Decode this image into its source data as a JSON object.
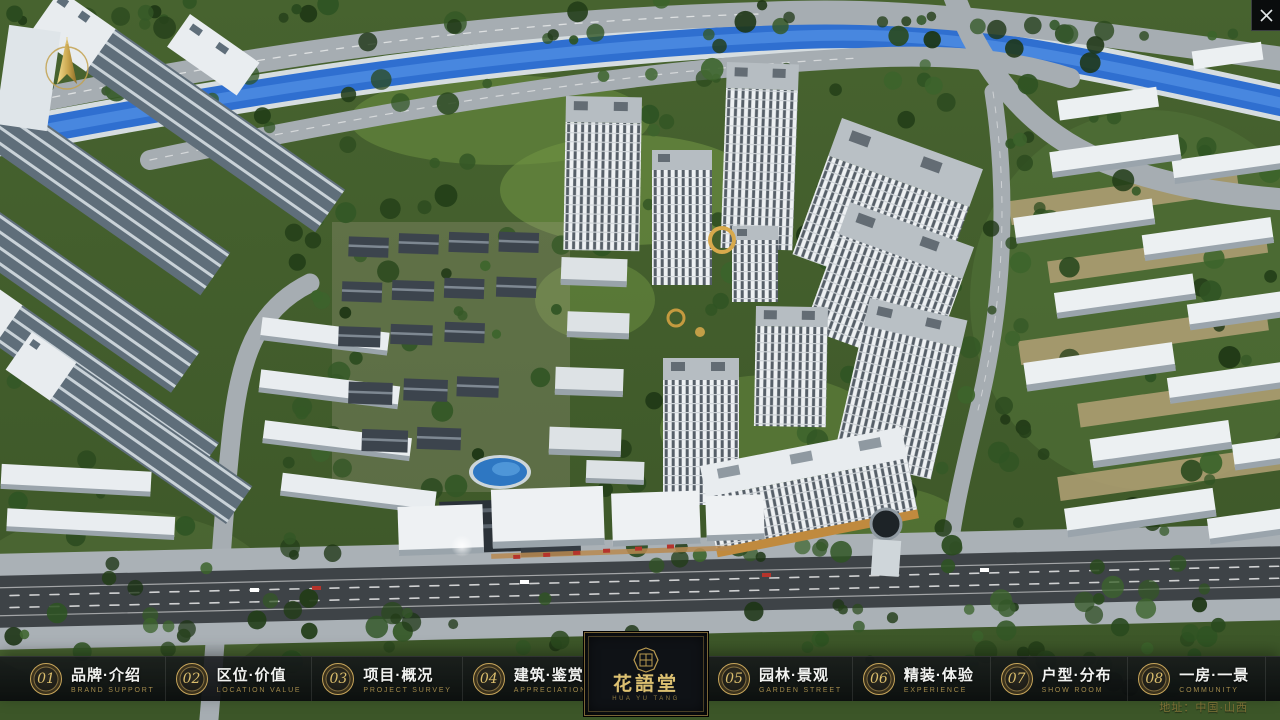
{
  "window": {
    "close_icon": "x",
    "scene_description": "aerial 3D rendering of residential community master plan"
  },
  "compass": {
    "icon": "north-arrow"
  },
  "menu": {
    "items": [
      {
        "num": "01",
        "label": "品牌·介绍",
        "sub": "BRAND SUPPORT"
      },
      {
        "num": "02",
        "label": "区位·价值",
        "sub": "LOCATION VALUE"
      },
      {
        "num": "03",
        "label": "项目·概况",
        "sub": "PROJECT SURVEY"
      },
      {
        "num": "04",
        "label": "建筑·鉴赏",
        "sub": "APPRECIATION"
      },
      {
        "num": "05",
        "label": "园林·景观",
        "sub": "GARDEN STREET"
      },
      {
        "num": "06",
        "label": "精装·体验",
        "sub": "EXPERIENCE"
      },
      {
        "num": "07",
        "label": "户型·分布",
        "sub": "SHOW ROOM"
      },
      {
        "num": "08",
        "label": "一房·一景",
        "sub": "COMMUNITY"
      }
    ]
  },
  "logo": {
    "title": "花語堂",
    "subtitle": "HUA YU TANG"
  },
  "footer": {
    "address": "地址：中国·山西"
  },
  "colors": {
    "gold_accent": "#c7a55a",
    "bar_background": "#101317",
    "river_blue": "#2f6fd0",
    "road_gray": "#a6adb2",
    "asphalt": "#3e4347",
    "tree_green": "#2b4a1f",
    "tower_white": "#eef1f3"
  }
}
